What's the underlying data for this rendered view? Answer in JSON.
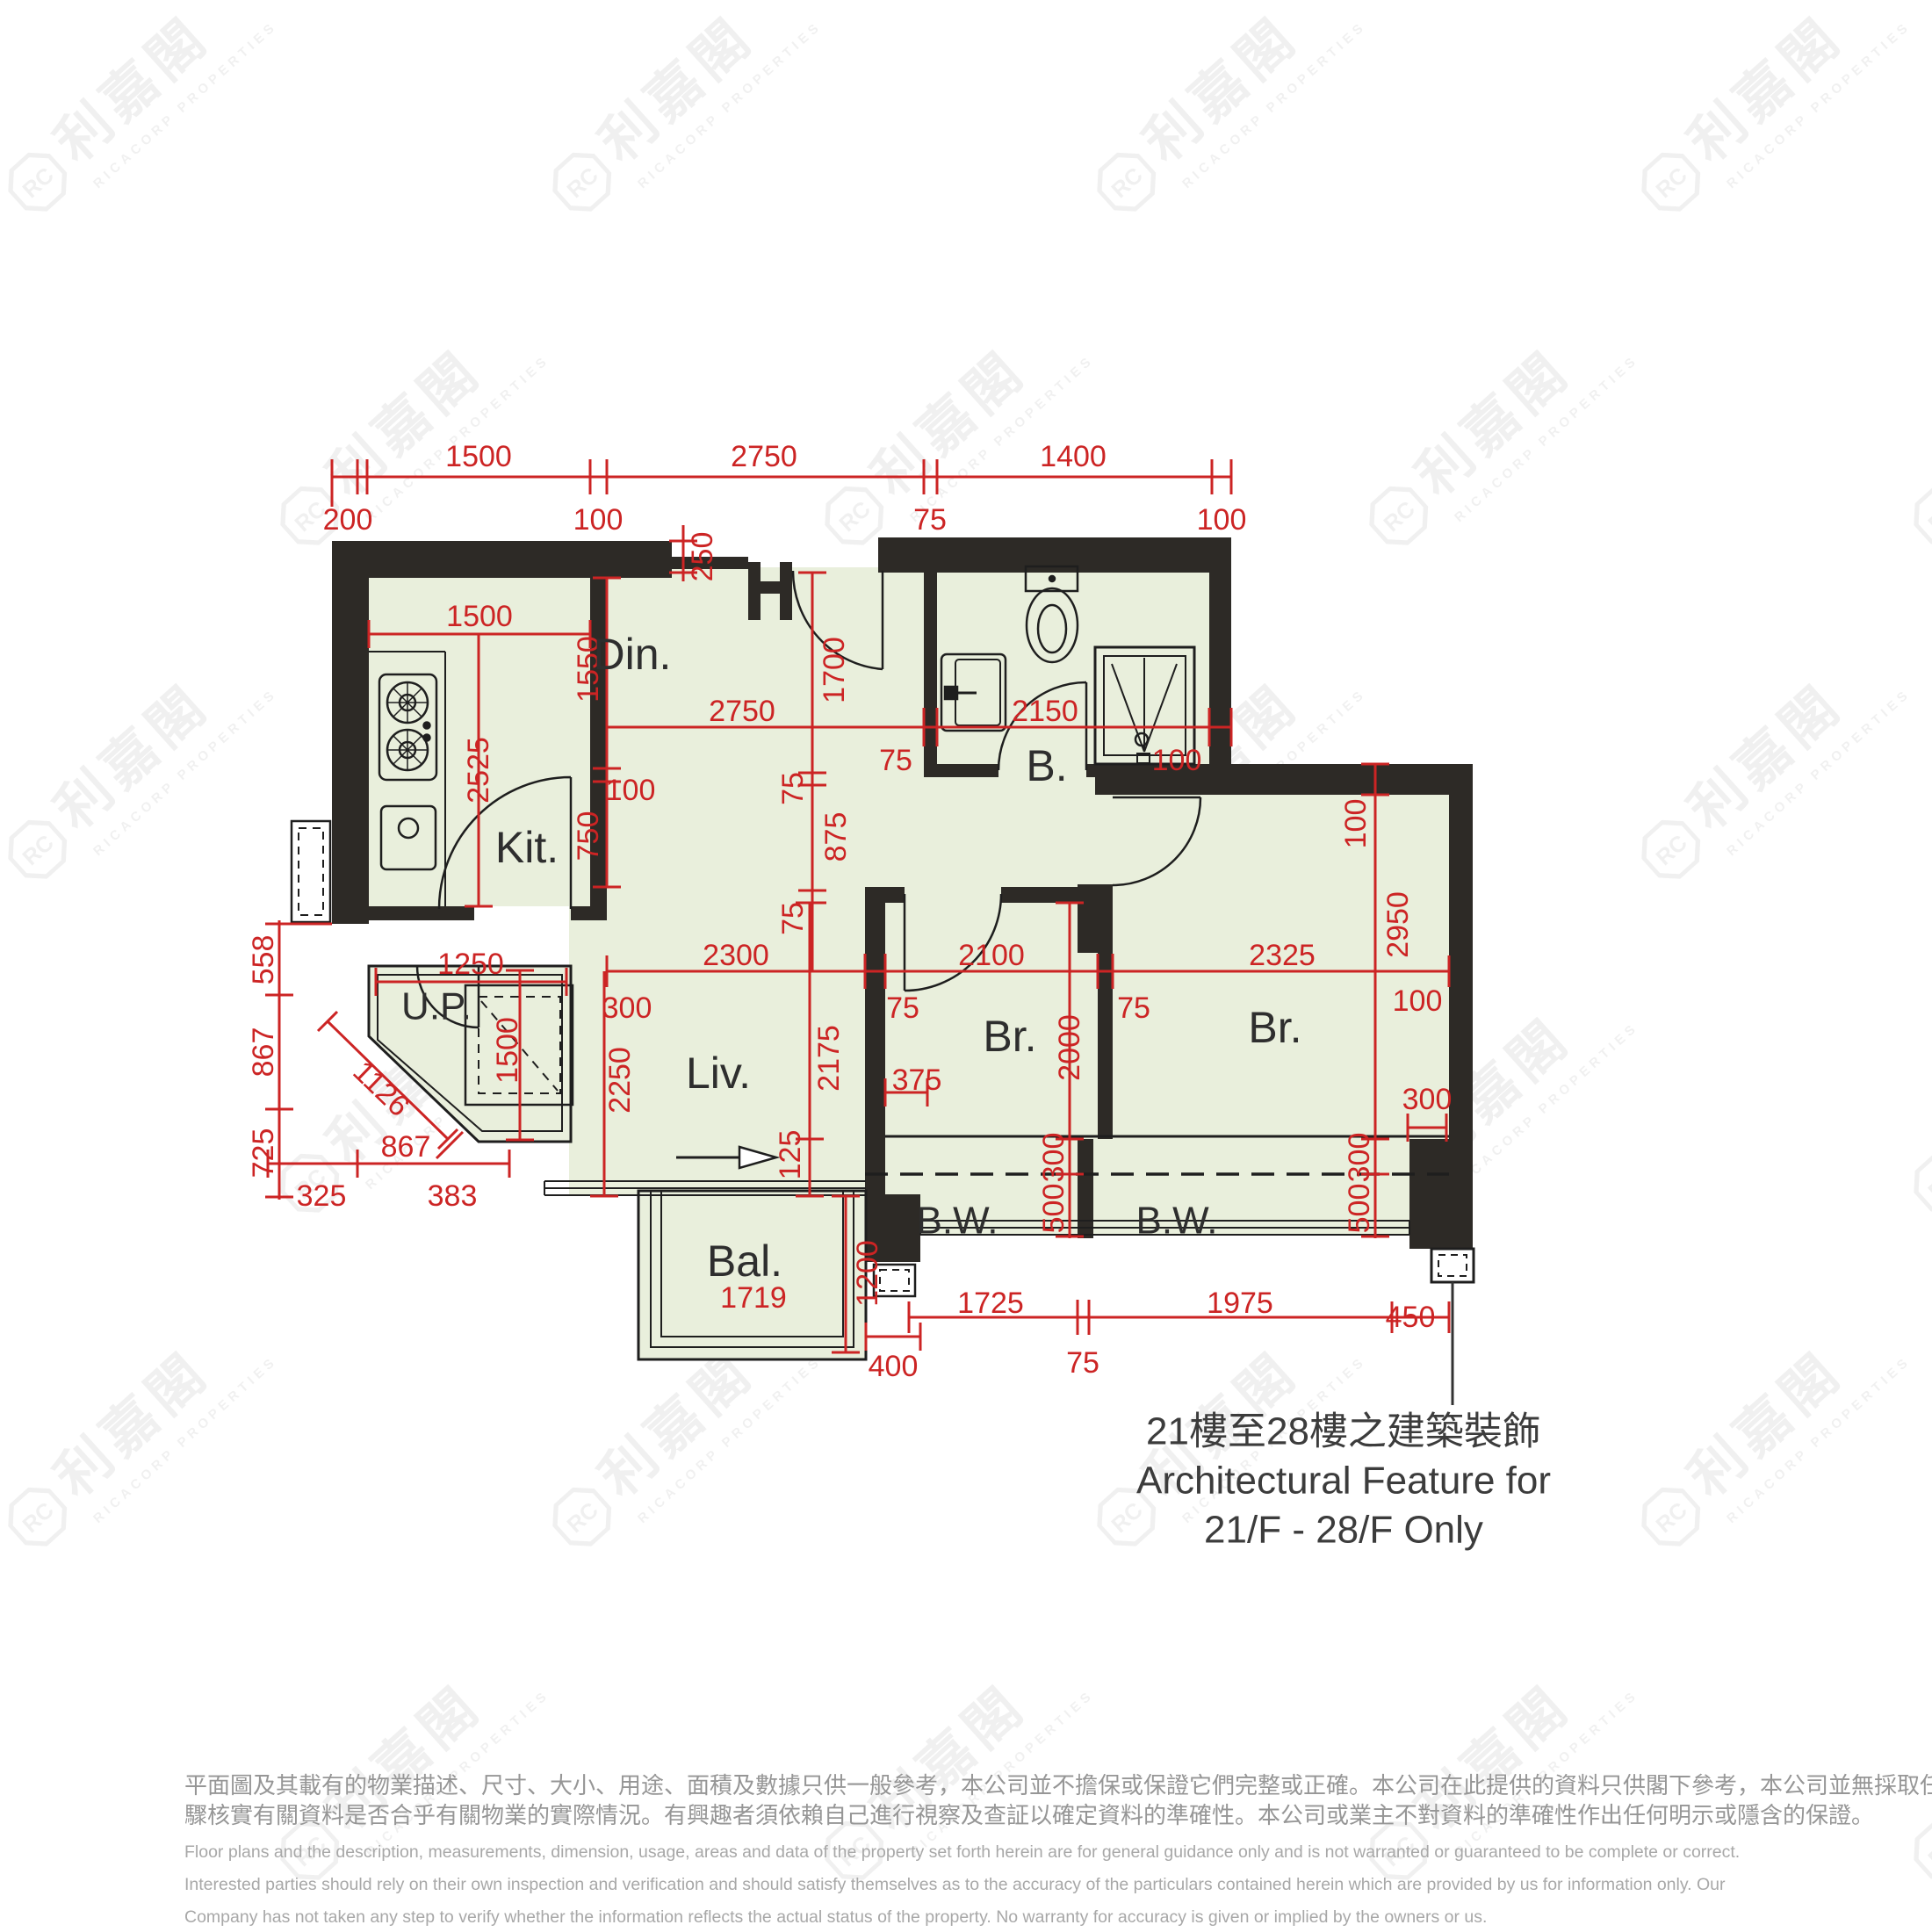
{
  "watermark": {
    "logo_text": "RC",
    "zh": "利嘉閣",
    "en": "RICACORP PROPERTIES"
  },
  "rooms": {
    "dining": "Din.",
    "kitchen": "Kit.",
    "bathroom": "B.",
    "bedroom_left": "Br.",
    "bedroom_right": "Br.",
    "living": "Liv.",
    "balcony": "Bal.",
    "utility_platform": "U.P.",
    "bay_window_left": "B.W.",
    "bay_window_right": "B.W."
  },
  "dims": {
    "top_1500": "1500",
    "top_2750": "2750",
    "top_1400": "1400",
    "top_200": "200",
    "top_100_a": "100",
    "top_75": "75",
    "top_100_b": "100",
    "kit_w_1500": "1500",
    "kit_h_2525": "2525",
    "din_1550": "1550",
    "din_100": "100",
    "din_750": "750",
    "din_w_2750": "2750",
    "bathwall_75": "75",
    "bath_w_2150": "2150",
    "shower_wall_100": "100",
    "recess_250": "250",
    "hall_1700": "1700",
    "mid_75_a": "75",
    "mid_875": "875",
    "mid_75_b": "75",
    "liv_w_2300": "2300",
    "liv_300": "300",
    "livbr_75": "75",
    "br1_w_2100": "2100",
    "brbr_75": "75",
    "br2_w_2325": "2325",
    "br2_100": "100",
    "liv_h_2250": "2250",
    "liv_h_2175": "2175",
    "liv_125": "125",
    "br1_375": "375",
    "br1_h_2000": "2000",
    "br2_h_2950": "2950",
    "br2_top_100": "100",
    "br2_side_300": "300",
    "bw1_300": "300",
    "bw1_500": "500",
    "bw2_300": "300",
    "bw2_500": "500",
    "bal_1719": "1719",
    "bal_1200": "1200",
    "bal_400": "400",
    "up_1250": "1250",
    "up_1500": "1500",
    "left_558": "558",
    "left_867": "867",
    "left_725": "725",
    "diag_1126": "1126",
    "diag_867": "867",
    "left_325": "325",
    "left_383": "383",
    "bot_1725": "1725",
    "bot_75": "75",
    "bot_1975": "1975",
    "bot_450": "450"
  },
  "annotation": {
    "zh": "21樓至28樓之建築裝飾",
    "en1": "Architectural Feature for",
    "en2": "21/F - 28/F Only"
  },
  "disclaimer": {
    "zh1": "平面圖及其載有的物業描述、尺寸、大小、用途、面積及數據只供一般參考，本公司並不擔保或保證它們完整或正確。本公司在此提供的資料只供閣下參考，本公司並無採取任何步",
    "zh2": "驟核實有關資料是否合乎有關物業的實際情況。有興趣者須依賴自己進行視察及查証以確定資料的準確性。本公司或業主不對資料的準確性作出任何明示或隱含的保證。",
    "en1": "Floor plans and the description, measurements, dimension, usage, areas and data of the property set forth herein are for general guidance only and is not warranted or guaranteed to be complete or correct.",
    "en2": "Interested parties should rely on their own inspection and verification and should satisfy themselves as to the accuracy of the particulars contained herein which are provided by us for information only.  Our",
    "en3": "Company has not taken any step to verify whether the information reflects the actual status of the property.  No warranty for accuracy is given or implied by the owners or us."
  },
  "colors": {
    "wall": "#2d2a26",
    "floor": "#e9efdc",
    "dimension": "#cc2424"
  }
}
